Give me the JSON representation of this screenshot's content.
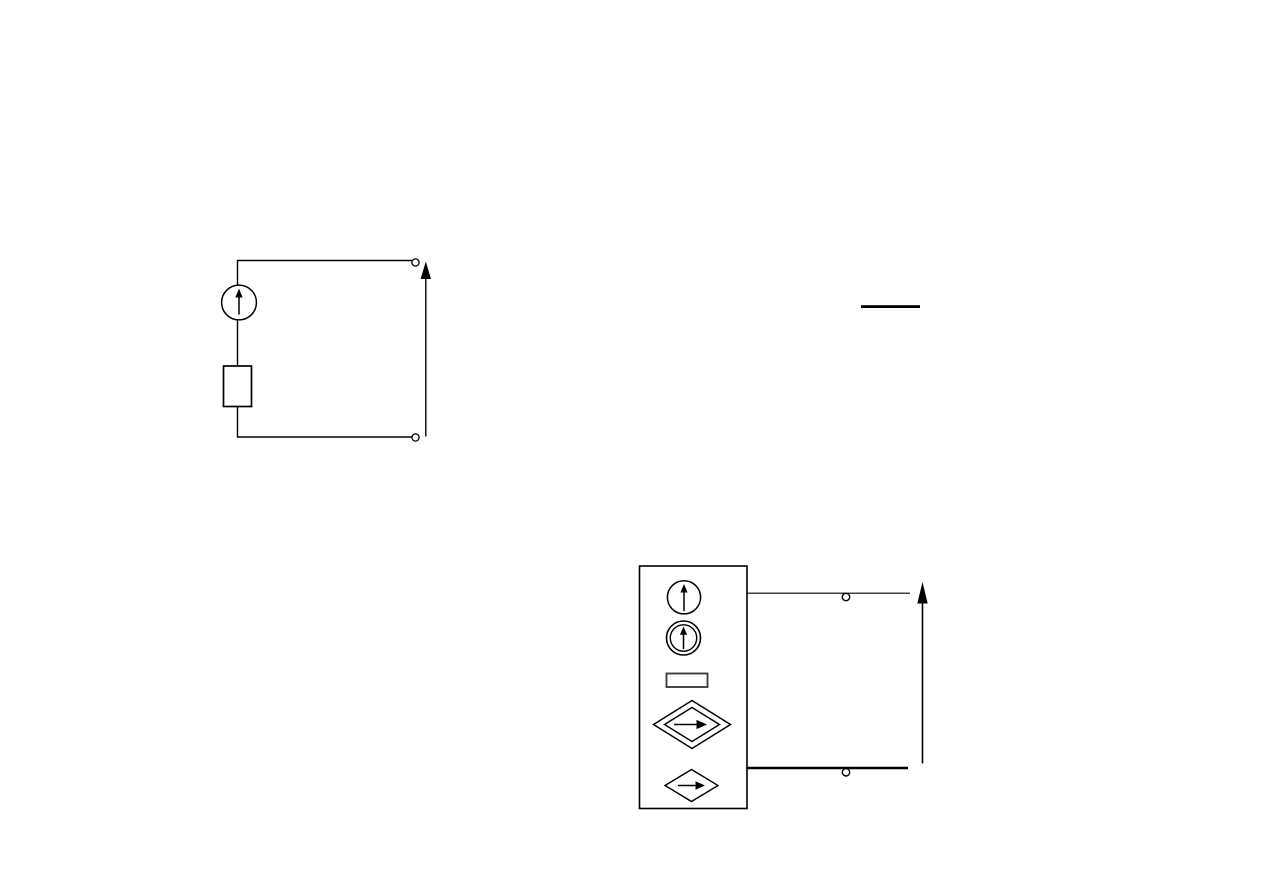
{
  "page": {
    "kind": "scanned textbook page fragment",
    "background": "#ffffff"
  },
  "colors": {
    "ink": "#000000",
    "ink_soft": "#3f3f3f",
    "paper": "#ffffff"
  },
  "figure1": {
    "aria_label": "Circuit: independent current source (circle with up arrow) in series with a resistor (rectangle), forming a loop ending in two open terminals; upward reference arrow drawn beside the terminals",
    "components": [
      {
        "type": "independent-current-source",
        "symbol": "circle-up-arrow"
      },
      {
        "type": "resistor",
        "symbol": "rectangle"
      },
      {
        "type": "open-terminal",
        "count": 2
      },
      {
        "type": "reference-arrow",
        "direction": "up"
      }
    ]
  },
  "fraction_bar": {
    "aria_label": "Bare horizontal fraction bar (numerator and denominator not rendered)"
  },
  "figure2": {
    "aria_label": "Box of source symbols: circle with up arrow, double circle with up arrow, small rectangle, double diamond with right arrow, diamond with right arrow; two wires lead to open terminals with a tall upward reference arrow",
    "components": [
      {
        "type": "independent-current-source",
        "symbol": "circle-up-arrow"
      },
      {
        "type": "independent-current-source-alt",
        "symbol": "double-circle-up-arrow"
      },
      {
        "type": "resistor",
        "symbol": "small-rectangle"
      },
      {
        "type": "dependent-source-alt",
        "symbol": "double-diamond-right-arrow"
      },
      {
        "type": "dependent-source",
        "symbol": "diamond-right-arrow"
      },
      {
        "type": "open-terminal",
        "count": 2
      },
      {
        "type": "reference-arrow",
        "direction": "up"
      }
    ]
  }
}
